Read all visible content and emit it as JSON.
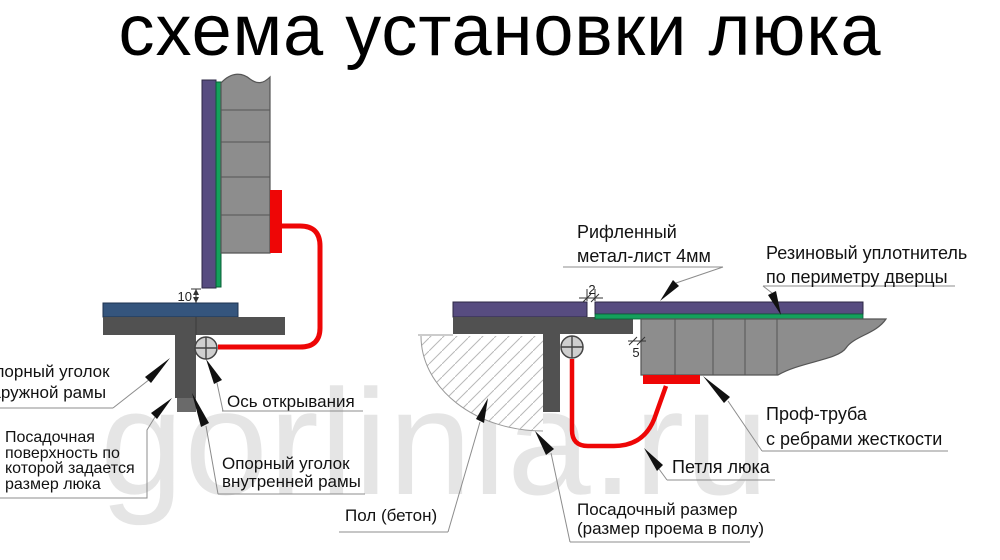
{
  "title": "схема установки люка",
  "watermark": "gorlinia.ru",
  "colors": {
    "lid_purple": "#574c80",
    "seal_green": "#14a05c",
    "angle_blue": "#35557d",
    "frame_gray": "#515151",
    "pipe_gray": "#8d8d8d",
    "hinge_red": "#ee0606",
    "leader_gray": "#8c8c8c",
    "watermark_gray": "#e5e5e5"
  },
  "left_diagram": {
    "labels": {
      "outer_angle": {
        "lines": [
          "Опорный уголок",
          "наружной рамы"
        ]
      },
      "seating_surface": {
        "lines": [
          "Посадочная",
          "поверхность по",
          "которой задается",
          "размер люка"
        ]
      },
      "opening_axis": {
        "lines": [
          "Ось открывания"
        ]
      },
      "inner_angle": {
        "lines": [
          "Опорный уголок",
          "внутренней рамы"
        ]
      }
    },
    "dimension_gap": "10"
  },
  "right_diagram": {
    "labels": {
      "sheet": {
        "lines": [
          "Рифленный",
          "метал-лист 4мм"
        ]
      },
      "rubber_seal": {
        "lines": [
          "Резиновый уплотнитель",
          "по периметру дверцы"
        ]
      },
      "pipe": {
        "lines": [
          "Проф-труба",
          "с ребрами жесткости"
        ]
      },
      "hinge": {
        "lines": [
          "Петля люка"
        ]
      },
      "floor": {
        "lines": [
          "Пол (бетон)"
        ]
      },
      "seat_size": {
        "lines": [
          "Посадочный размер",
          "(размер проема в полу)"
        ]
      }
    },
    "dimension_top_gap": "2",
    "dimension_side_gap": "5"
  }
}
